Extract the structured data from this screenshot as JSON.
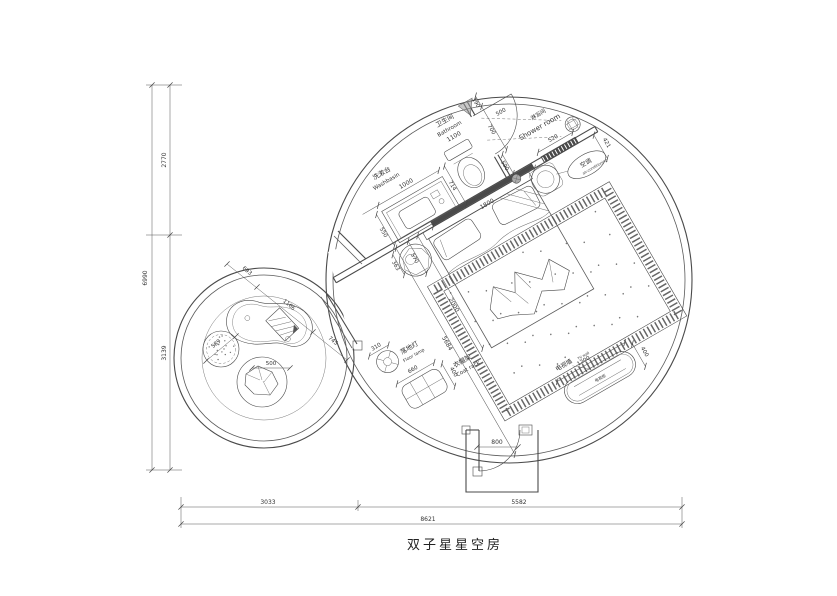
{
  "title": "双子星星空房",
  "outer_dimensions": {
    "total_height": "6990",
    "upper_height": "2770",
    "lower_height": "3139",
    "total_width": "8621",
    "left_width": "3033",
    "right_width": "5582"
  },
  "bathroom_zone": {
    "washbasin": {
      "zh": "洗漱台",
      "en": "Washbasin",
      "width": "1000",
      "depth": "550"
    },
    "bathroom": {
      "zh": "卫生间",
      "en": "Bathroom",
      "width": "1100",
      "offset": "714",
      "seg_a": "190",
      "seg_b": "700",
      "door_swing": "500",
      "misc": "590"
    },
    "shower": {
      "zh": "淋浴间",
      "en": "Shower room"
    },
    "window_width": "520",
    "sliding_door": "1800"
  },
  "bedroom_zone": {
    "ac": {
      "zh": "空调",
      "en": "air-conditioning",
      "offset": "421"
    },
    "bed": {
      "length": "2000",
      "diagonal": "5684",
      "stool_a": "363",
      "stool_b": "570"
    },
    "lamp": {
      "zh": "落地灯",
      "en": "Floor lamp",
      "diameter": "310"
    },
    "coat_rack": {
      "zh": "衣帽架",
      "en": "Coat rack",
      "width": "660",
      "depth": "400"
    },
    "tv": {
      "wall_zh": "电视墙",
      "wall_en": "TV wall",
      "cabinet_zh": "电视柜",
      "width": "1200",
      "depth": "400"
    },
    "entry_door": "800"
  },
  "lounge_zone": {
    "chain": {
      "a": "693",
      "b": "1166",
      "c": "745"
    },
    "stool_diameter": "589",
    "seat_diameter": "500"
  }
}
